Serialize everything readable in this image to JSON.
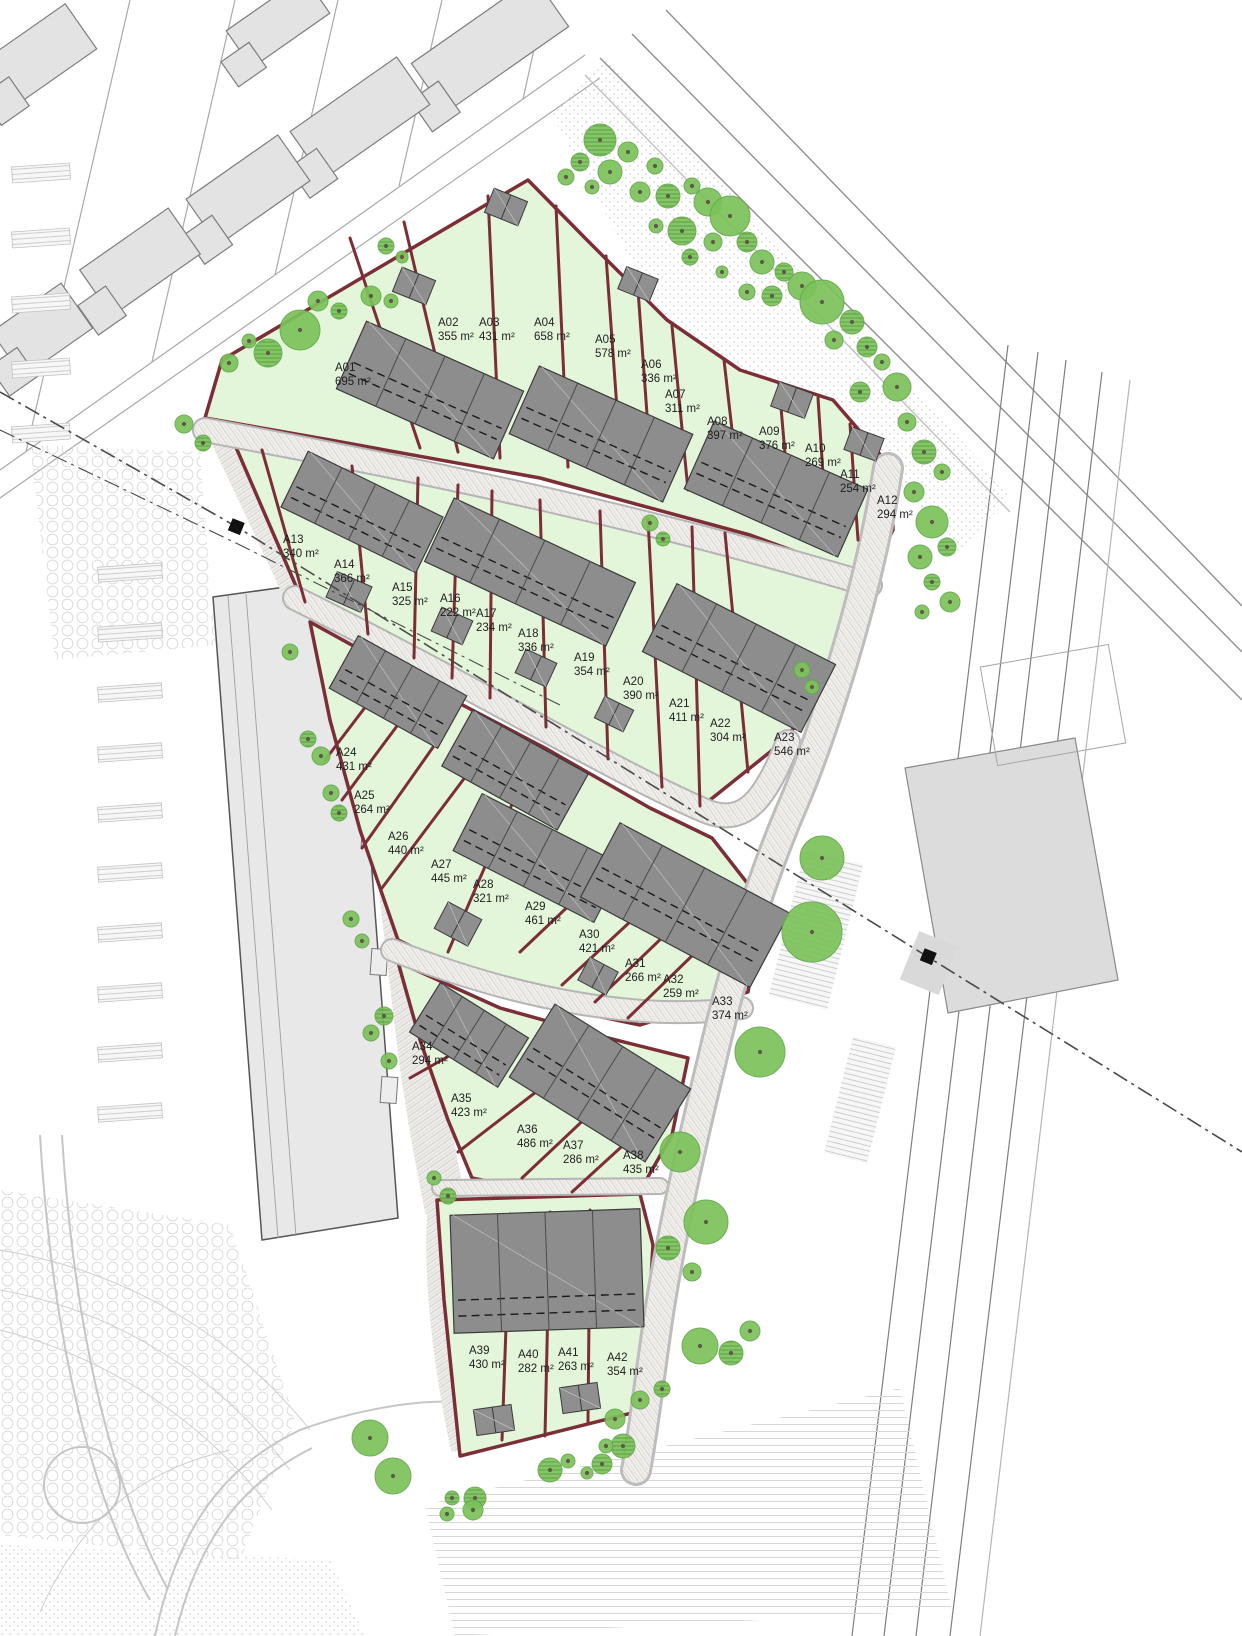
{
  "drawing": {
    "kind": "residential development site plan",
    "unit_suffix": "m²",
    "colors": {
      "plot_fill": "#e4f6da",
      "plot_boundary": "#7c2e36",
      "building": "#8d8d8d",
      "tree": "#7cc25b",
      "existing_building": "#e3e3e3"
    }
  },
  "plots": [
    {
      "id": "A01",
      "area": "695 m²",
      "x": 335,
      "y": 371
    },
    {
      "id": "A02",
      "area": "355 m²",
      "x": 438,
      "y": 326
    },
    {
      "id": "A03",
      "area": "431 m²",
      "x": 479,
      "y": 326
    },
    {
      "id": "A04",
      "area": "658 m²",
      "x": 534,
      "y": 326
    },
    {
      "id": "A05",
      "area": "578 m²",
      "x": 595,
      "y": 343
    },
    {
      "id": "A06",
      "area": "336 m²",
      "x": 641,
      "y": 368
    },
    {
      "id": "A07",
      "area": "311 m²",
      "x": 665,
      "y": 398
    },
    {
      "id": "A08",
      "area": "397 m²",
      "x": 707,
      "y": 425
    },
    {
      "id": "A09",
      "area": "376 m²",
      "x": 759,
      "y": 435
    },
    {
      "id": "A10",
      "area": "269 m²",
      "x": 805,
      "y": 452
    },
    {
      "id": "A11",
      "area": "254 m²",
      "x": 840,
      "y": 478
    },
    {
      "id": "A12",
      "area": "294 m²",
      "x": 877,
      "y": 504
    },
    {
      "id": "A13",
      "area": "340 m²",
      "x": 283,
      "y": 543
    },
    {
      "id": "A14",
      "area": "366 m²",
      "x": 334,
      "y": 568
    },
    {
      "id": "A15",
      "area": "325 m²",
      "x": 392,
      "y": 591
    },
    {
      "id": "A16",
      "area": "222 m²",
      "x": 440,
      "y": 602
    },
    {
      "id": "A17",
      "area": "234 m²",
      "x": 476,
      "y": 617
    },
    {
      "id": "A18",
      "area": "336 m²",
      "x": 518,
      "y": 637
    },
    {
      "id": "A19",
      "area": "354 m²",
      "x": 574,
      "y": 661
    },
    {
      "id": "A20",
      "area": "390 m²",
      "x": 623,
      "y": 685
    },
    {
      "id": "A21",
      "area": "411 m²",
      "x": 669,
      "y": 707
    },
    {
      "id": "A22",
      "area": "304 m²",
      "x": 710,
      "y": 727
    },
    {
      "id": "A23",
      "area": "546 m²",
      "x": 774,
      "y": 741
    },
    {
      "id": "A24",
      "area": "431 m²",
      "x": 336,
      "y": 756
    },
    {
      "id": "A25",
      "area": "264 m²",
      "x": 354,
      "y": 799
    },
    {
      "id": "A26",
      "area": "440 m²",
      "x": 388,
      "y": 840
    },
    {
      "id": "A27",
      "area": "445 m²",
      "x": 431,
      "y": 868
    },
    {
      "id": "A28",
      "area": "321 m²",
      "x": 473,
      "y": 888
    },
    {
      "id": "A29",
      "area": "461 m²",
      "x": 525,
      "y": 910
    },
    {
      "id": "A30",
      "area": "421 m²",
      "x": 579,
      "y": 938
    },
    {
      "id": "A31",
      "area": "266 m²",
      "x": 625,
      "y": 967
    },
    {
      "id": "A32",
      "area": "259 m²",
      "x": 663,
      "y": 983
    },
    {
      "id": "A33",
      "area": "374 m²",
      "x": 712,
      "y": 1005
    },
    {
      "id": "A34",
      "area": "294 m²",
      "x": 412,
      "y": 1050
    },
    {
      "id": "A35",
      "area": "423 m²",
      "x": 451,
      "y": 1102
    },
    {
      "id": "A36",
      "area": "486 m²",
      "x": 517,
      "y": 1133
    },
    {
      "id": "A37",
      "area": "286 m²",
      "x": 563,
      "y": 1149
    },
    {
      "id": "A38",
      "area": "435 m²",
      "x": 623,
      "y": 1159
    },
    {
      "id": "A39",
      "area": "430 m²",
      "x": 469,
      "y": 1354
    },
    {
      "id": "A40",
      "area": "282 m²",
      "x": 518,
      "y": 1358
    },
    {
      "id": "A41",
      "area": "263 m²",
      "x": 558,
      "y": 1356
    },
    {
      "id": "A42",
      "area": "354 m²",
      "x": 607,
      "y": 1361
    }
  ]
}
